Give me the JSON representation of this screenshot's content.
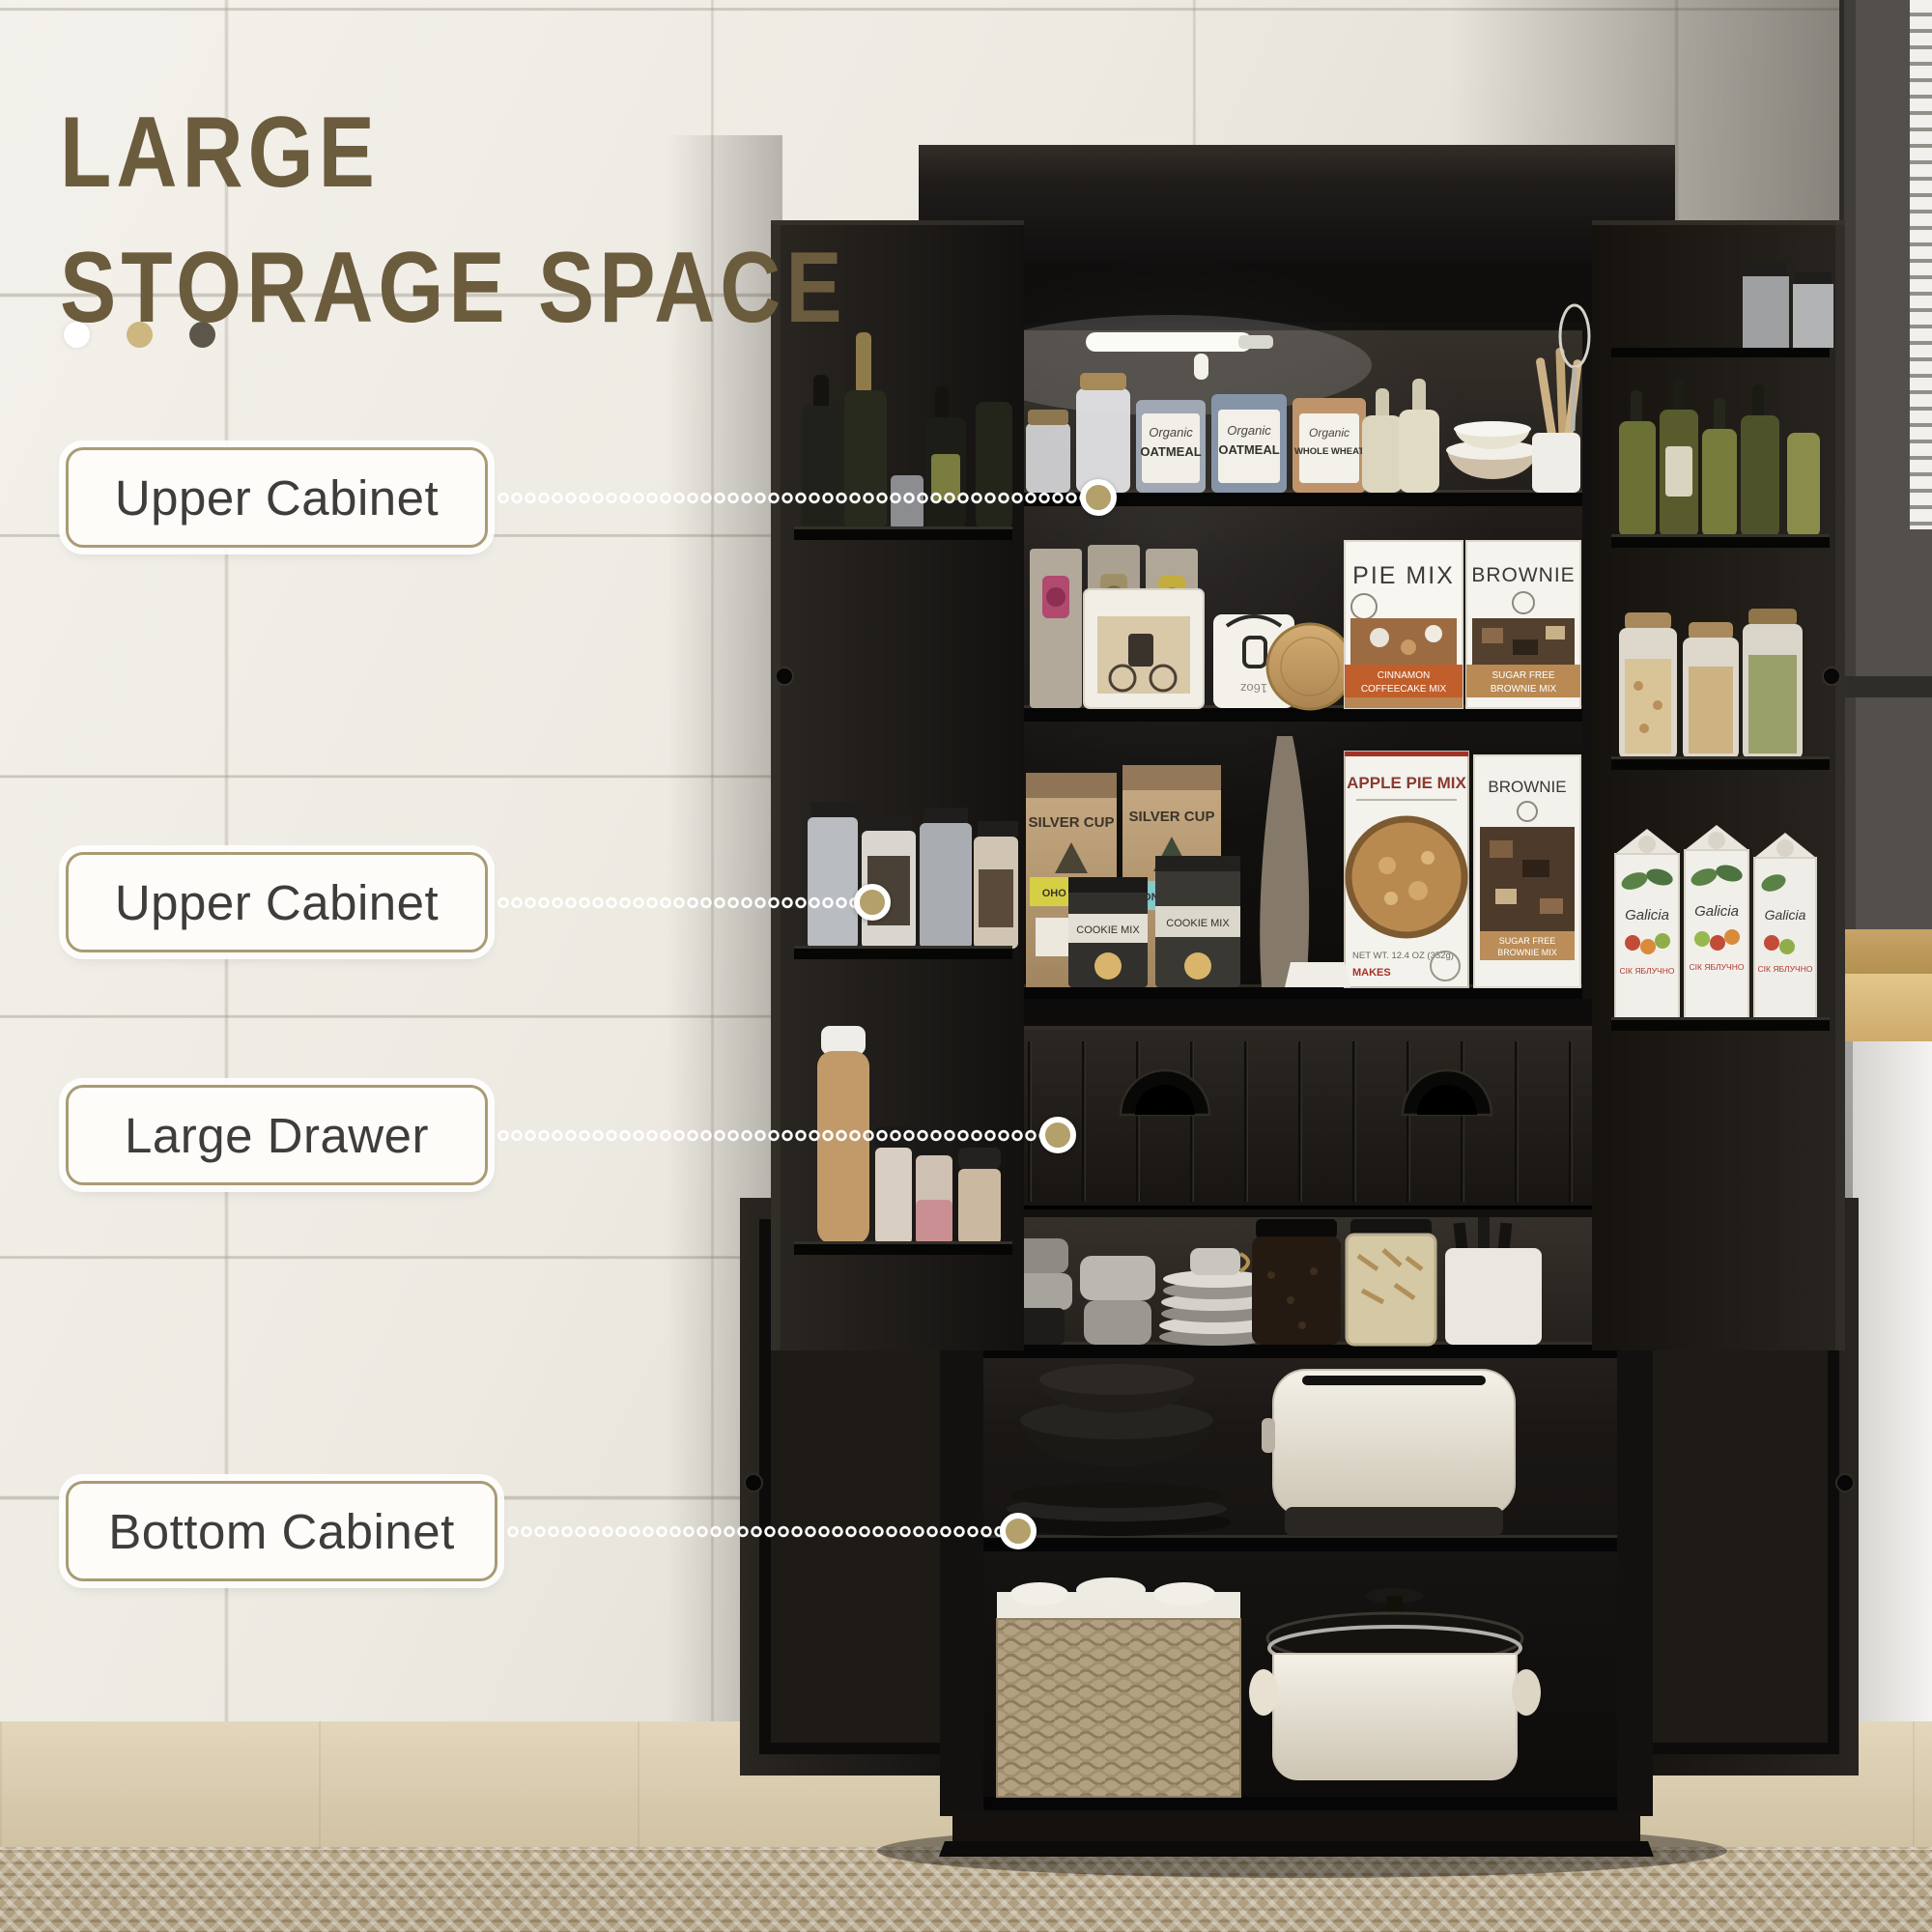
{
  "title": {
    "line1": "LARGE",
    "line2": "STORAGE SPACE",
    "color": "#6b5c3d"
  },
  "callouts": [
    {
      "label": "Upper Cabinet"
    },
    {
      "label": "Upper Cabinet"
    },
    {
      "label": "Large Drawer"
    },
    {
      "label": "Bottom Cabinet"
    }
  ],
  "palette": {
    "wall": "#ece9e1",
    "cabinet_black": "#17140f",
    "label_border": "#a99c74",
    "label_text": "#3e3d3b",
    "leader_dot": "#b3a06a",
    "accent_dot_white": "#ffffff",
    "accent_dot_tan": "#cdb67f",
    "accent_dot_brown": "#5d564a",
    "floor_wood": "#d8cbae",
    "rug": "#b3a286",
    "counter_wood": "#d9bc82"
  },
  "products": {
    "organic": "Organic",
    "oatmeal": "OATMEAL",
    "whole_wheat": "WHOLE WHEAT",
    "pancake_sub": "PANCAKE AND WAFFLE MIX",
    "pie_mix": "PIE MIX",
    "pie_mix_band1": "CINNAMON",
    "pie_mix_band2": "COFFEECAKE MIX",
    "brownie": "BROWNIE",
    "brownie_band1": "SUGAR FREE",
    "brownie_band2": "BROWNIE MIX",
    "silver_cup": "SILVER CUP",
    "bag_band_1": "OHO MOJO",
    "bag_band_2": "WONDERLAND",
    "cookie_mix": "COOKIE MIX",
    "apple_pie_mix": "APPLE PIE MIX",
    "apple_net": "NET WT. 12.4 OZ (352g)",
    "apple_makes": "MAKES",
    "juice": "Galicia",
    "juice_sub": "СІК ЯБЛУЧНО",
    "sugar_oz": "16oz"
  }
}
